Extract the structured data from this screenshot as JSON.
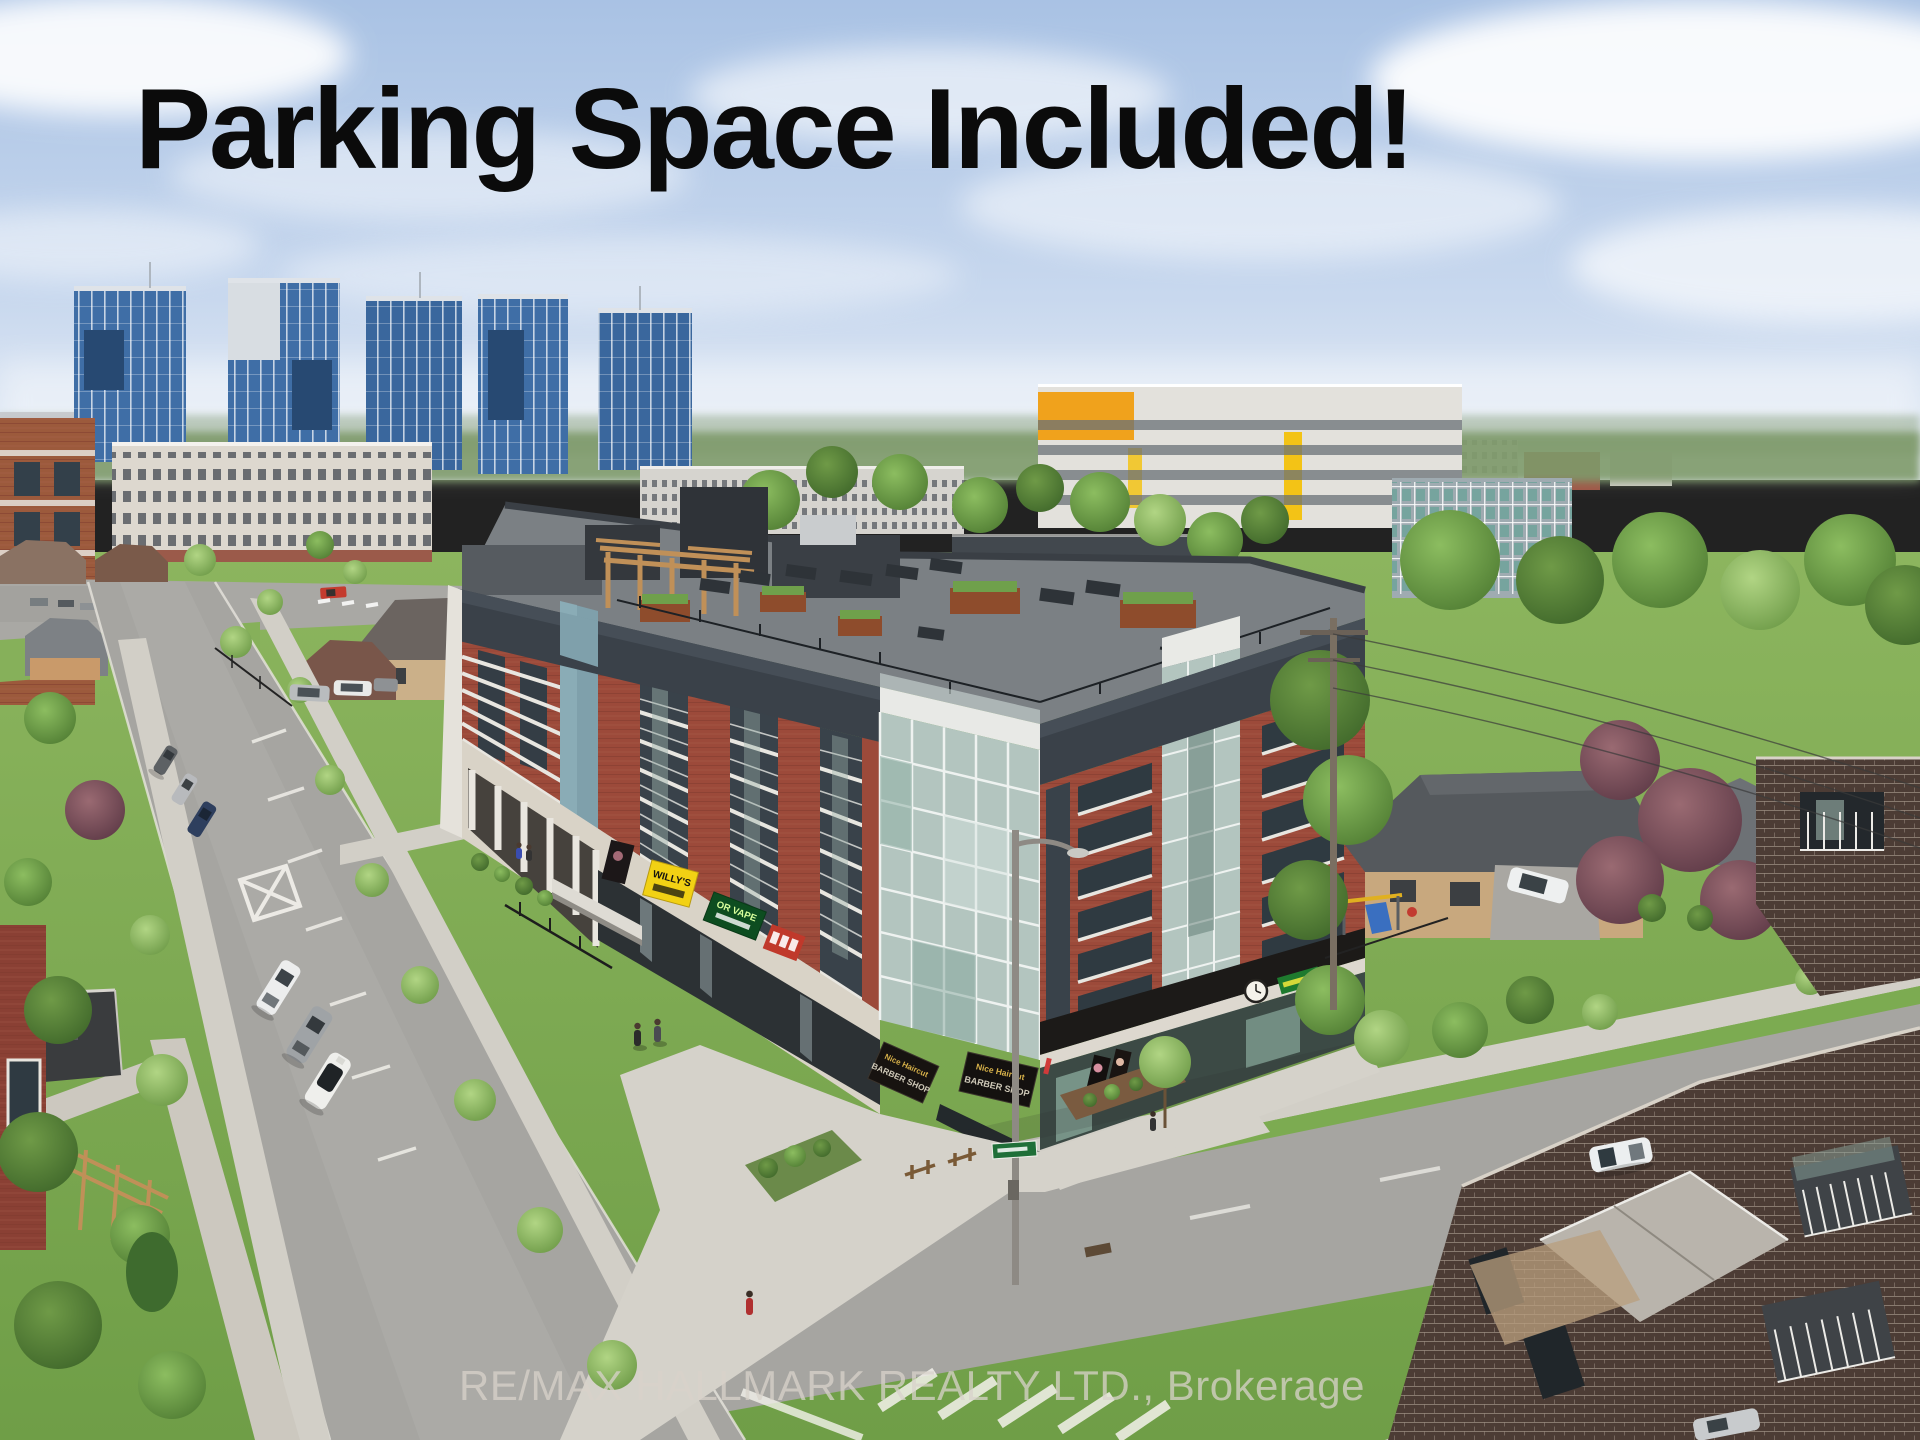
{
  "photo_overlay": {
    "headline": "Parking Space Included!",
    "watermark": "RE/MAX HALLMARK REALTY LTD., Brokerage"
  },
  "storefront_signs": {
    "yellow_sign": "WILLY'S",
    "vape_sign": "OR VAPE",
    "barber_line1": "Nice Haircut",
    "barber_line2": "BARBER SHOP"
  },
  "colors": {
    "headline_text": "#0b0b0b",
    "watermark_text": "#d9d3cb",
    "sky_top": "#a9c2e4",
    "sky_horizon": "#e8eef6",
    "main_brick": "#9c4a3a",
    "parapet_band": "#3a4149",
    "corner_glass": "#b3c5bf",
    "pergola_wood": "#c09058",
    "yellow_sign_bg": "#f2d114",
    "vape_sign_bg": "#0d4d20",
    "barber_sign_bg": "#171310",
    "grass": "#7cab51",
    "asphalt": "#a6a5a1",
    "blue_tower_glass": "#3f6ea6",
    "dark_brick_foreground": "#4c3c35"
  }
}
